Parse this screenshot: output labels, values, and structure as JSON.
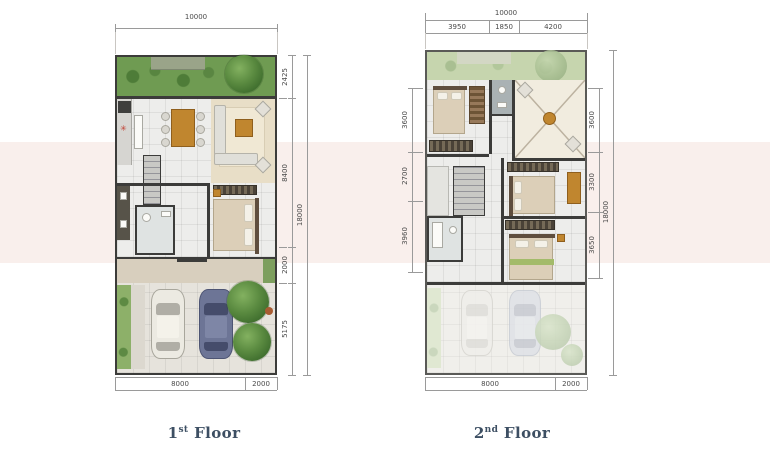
{
  "background": {
    "page_color": "#ffffff",
    "band_color": "#f9efec"
  },
  "floor1": {
    "title": {
      "num": "1",
      "sup": "st",
      "word": "Floor"
    },
    "dims": {
      "top_total": "10000",
      "right_segments": [
        "2425",
        "8400",
        "2000",
        "5175"
      ],
      "right_total": "18000",
      "bottom_segments": [
        "8000",
        "2000"
      ]
    }
  },
  "floor2": {
    "title": {
      "num": "2",
      "sup": "nd",
      "word": "Floor"
    },
    "dims": {
      "top_total": "10000",
      "top_segments": [
        "3950",
        "1850",
        "4200"
      ],
      "left_segments": [
        "3600",
        "2700",
        "3960"
      ],
      "right_segments": [
        "3600",
        "3300",
        "3650"
      ],
      "right_total": "18000",
      "bottom_segments": [
        "8000",
        "2000"
      ]
    }
  },
  "colors": {
    "floor_label": "#3d4f63",
    "dim_line": "#9a9a9a",
    "dim_text": "#4a4a4a",
    "garden_green": "#6f9b52",
    "tree_green": "#4f7f39",
    "car_white": "#eceae2",
    "car_blue": "#6d7596",
    "wood_accent": "#c0862f"
  }
}
